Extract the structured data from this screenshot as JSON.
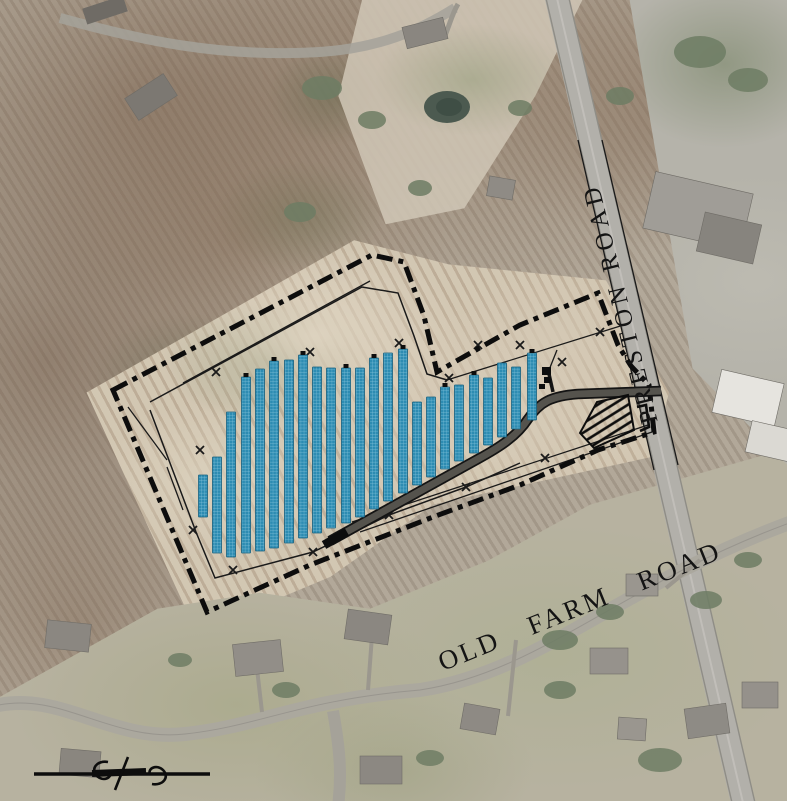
{
  "labels": {
    "preston_road": "PRESTON ROAD",
    "old_farm_road": "OLD FARM ROAD"
  },
  "colors": {
    "panel_fill": "#2d8cb2",
    "panel_grid": "#9fd4e6",
    "panel_edge": "#16607f",
    "boundary": "#0d0d0d",
    "fence": "#1a1a1a",
    "access_road_fill": "#55534d",
    "access_road_edge": "#141414",
    "hatch": "#0d0d0d",
    "label_text": "#141414"
  },
  "site_plan": {
    "panel_row_width": 9,
    "panel_rows": [
      {
        "x": 203,
        "top": 475,
        "bottom": 517,
        "cap": false
      },
      {
        "x": 217,
        "top": 457,
        "bottom": 553,
        "cap": false
      },
      {
        "x": 231,
        "top": 412,
        "bottom": 557,
        "cap": false
      },
      {
        "x": 246,
        "top": 377,
        "bottom": 553,
        "cap": true
      },
      {
        "x": 260,
        "top": 369,
        "bottom": 551,
        "cap": false
      },
      {
        "x": 274,
        "top": 361,
        "bottom": 548,
        "cap": true
      },
      {
        "x": 289,
        "top": 360,
        "bottom": 543,
        "cap": false
      },
      {
        "x": 303,
        "top": 355,
        "bottom": 538,
        "cap": true
      },
      {
        "x": 317,
        "top": 367,
        "bottom": 533,
        "cap": false
      },
      {
        "x": 331,
        "top": 368,
        "bottom": 528,
        "cap": false
      },
      {
        "x": 346,
        "top": 368,
        "bottom": 523,
        "cap": true
      },
      {
        "x": 360,
        "top": 368,
        "bottom": 517,
        "cap": false
      },
      {
        "x": 374,
        "top": 358,
        "bottom": 509,
        "cap": true
      },
      {
        "x": 388,
        "top": 353,
        "bottom": 501,
        "cap": false
      },
      {
        "x": 403,
        "top": 349,
        "bottom": 493,
        "cap": true
      },
      {
        "x": 417,
        "top": 402,
        "bottom": 485,
        "cap": false
      },
      {
        "x": 431,
        "top": 397,
        "bottom": 477,
        "cap": false
      },
      {
        "x": 445,
        "top": 387,
        "bottom": 469,
        "cap": true
      },
      {
        "x": 459,
        "top": 385,
        "bottom": 461,
        "cap": false
      },
      {
        "x": 474,
        "top": 375,
        "bottom": 453,
        "cap": true
      },
      {
        "x": 488,
        "top": 378,
        "bottom": 445,
        "cap": false
      },
      {
        "x": 502,
        "top": 363,
        "bottom": 437,
        "cap": false
      },
      {
        "x": 516,
        "top": 367,
        "bottom": 429,
        "cap": false
      },
      {
        "x": 532,
        "top": 353,
        "bottom": 420,
        "cap": true
      }
    ],
    "boundary_points": "113,390 372,255 404,262 424,316 437,372 520,325 598,293 618,345 631,366 649,385 654,432 598,450 520,485 433,517 310,565 207,612",
    "boundary_dash": "16 6 5 6",
    "fence_lines": [
      "150,402 362,287 398,293 414,336 427,374 447,380",
      "150,410 196,532 215,578 313,552 389,515 466,487 520,463"
    ],
    "thin_lines": [
      [
        183,
        383,
        370,
        281
      ],
      [
        128,
        407,
        167,
        460
      ],
      [
        167,
        467,
        183,
        510
      ],
      [
        447,
        380,
        630,
        323
      ],
      [
        352,
        522,
        648,
        425
      ],
      [
        360,
        532,
        652,
        432
      ],
      [
        578,
        140,
        654,
        470
      ],
      [
        602,
        140,
        678,
        465
      ],
      [
        549,
        370,
        557,
        350
      ]
    ],
    "fence_x_marks": [
      [
        216,
        372
      ],
      [
        310,
        352
      ],
      [
        399,
        343
      ],
      [
        449,
        378
      ],
      [
        520,
        345
      ],
      [
        600,
        332
      ],
      [
        478,
        345
      ],
      [
        562,
        362
      ],
      [
        200,
        450
      ],
      [
        193,
        530
      ],
      [
        233,
        570
      ],
      [
        313,
        552
      ],
      [
        389,
        515
      ],
      [
        466,
        487
      ],
      [
        545,
        458
      ]
    ],
    "access_road_path": "M661,391 L578,394 C551,396 540,402 528,419 C517,436 500,447 478,459 L330,541",
    "access_road_end_cap": "M347,532 L324,545",
    "access_road_spur": "M553,392 L549,374",
    "equipment_rects": [
      [
        542,
        367,
        9,
        8
      ],
      [
        544,
        377,
        7,
        6
      ],
      [
        539,
        384,
        6,
        5
      ]
    ],
    "bracket_points": "637,407 646,405 649,427 640,431",
    "hatch_points": "580,433 597,402 628,395 634,430 594,448"
  }
}
